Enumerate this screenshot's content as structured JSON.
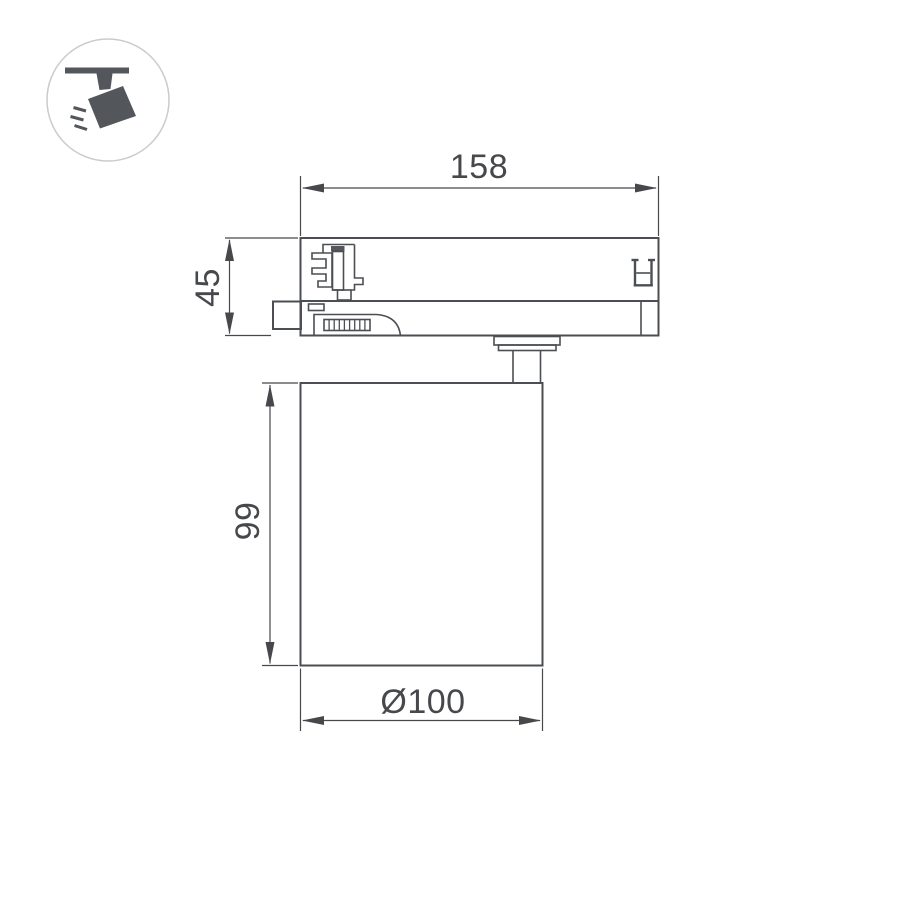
{
  "icon": {
    "name": "track-spotlight-icon"
  },
  "dimensions": {
    "adapter_width": {
      "label": "158"
    },
    "adapter_height": {
      "label": "45"
    },
    "body_height": {
      "label": "99"
    },
    "body_diameter": {
      "label": "Ø100"
    }
  },
  "colors": {
    "line": "#4b4e52",
    "dimension": "#46484b",
    "icon_glyph": "#53575b",
    "icon_circle_border": "#c9cbcd",
    "background": "#ffffff"
  }
}
